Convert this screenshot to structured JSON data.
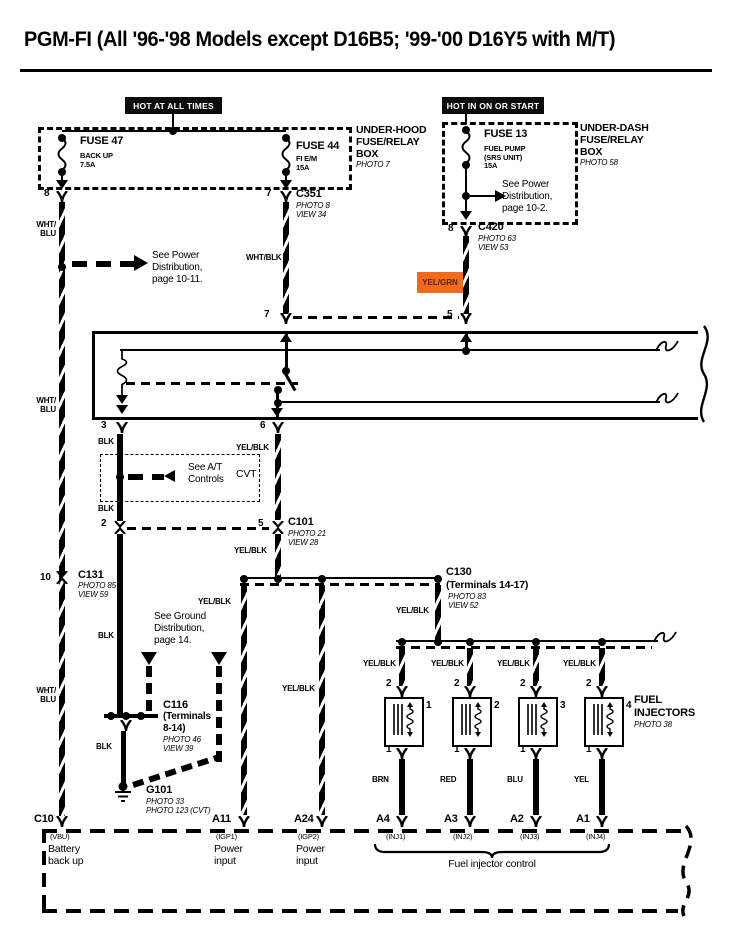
{
  "title": "PGM-FI (All '96-'98 Models except D16B5; '99-'00 D16Y5 with M/T)",
  "banners": {
    "left": "HOT AT ALL TIMES",
    "right": "HOT IN ON OR START"
  },
  "underhood": {
    "name": "UNDER-HOOD\nFUSE/RELAY\nBOX",
    "photo": "PHOTO 7",
    "fuse47": {
      "name": "FUSE 47",
      "desc": "BACK UP\n7.5A"
    },
    "fuse44": {
      "name": "FUSE 44",
      "desc": "FI E/M\n15A"
    }
  },
  "underdash": {
    "name": "UNDER-DASH\nFUSE/RELAY\nBOX",
    "photo": "PHOTO 58",
    "fuse13": {
      "name": "FUSE 13",
      "desc": "FUEL PUMP\n(SRS UNIT)\n15A"
    },
    "note": "See Power\nDistribution,\npage 10-2."
  },
  "c351": {
    "pin_l": "8",
    "pin_r": "7",
    "name": "C351",
    "photo": "PHOTO 8",
    "view": "VIEW 34"
  },
  "c420": {
    "pin_t": "8",
    "pin_b": "5",
    "name": "C420",
    "photo": "PHOTO 63",
    "view": "VIEW 53"
  },
  "relay": {
    "pin7": "7",
    "pin5": "5",
    "pin3": "3",
    "pin6": "6"
  },
  "c101": {
    "pin2": "2",
    "pin5": "5",
    "name": "C101",
    "photo": "PHOTO 21",
    "view": "VIEW 28"
  },
  "c131": {
    "pin": "10",
    "name": "C131",
    "photo": "PHOTO 85",
    "view": "VIEW 59"
  },
  "c130": {
    "name": "C130",
    "sub": "(Terminals 14-17)",
    "photo": "PHOTO 83",
    "view": "VIEW 52"
  },
  "c116": {
    "name": "C116",
    "sub": "(Terminals\n8-14)",
    "photo": "PHOTO 46",
    "view": "VIEW 39"
  },
  "g101": {
    "name": "G101",
    "photo": "PHOTO 33",
    "photo2": "PHOTO 123 (CVT)"
  },
  "notes": {
    "power11": "See Power\nDistribution,\npage 10-11.",
    "at": "See A/T\nControls",
    "cvt": "CVT",
    "ground": "See Ground\nDistribution,\npage 14."
  },
  "wires": {
    "wht_blu": "WHT/\nBLU",
    "wht_blk": "WHT/BLK",
    "yel_grn": "YEL/GRN",
    "blk": "BLK",
    "yel_blk": "YEL/BLK"
  },
  "injectors": {
    "title": "FUEL\nINJECTORS",
    "photo": "PHOTO 38",
    "items": [
      {
        "num": "1",
        "pin_top": "2",
        "pin_bot": "1",
        "color": "BRN"
      },
      {
        "num": "2",
        "pin_top": "2",
        "pin_bot": "1",
        "color": "RED"
      },
      {
        "num": "3",
        "pin_top": "2",
        "pin_bot": "1",
        "color": "BLU"
      },
      {
        "num": "4",
        "pin_top": "2",
        "pin_bot": "1",
        "color": "YEL"
      }
    ]
  },
  "ecm": {
    "bracket": "Fuel injector control",
    "terminals": [
      {
        "id": "C10",
        "code": "(VBU)",
        "desc": "Battery\nback up"
      },
      {
        "id": "A11",
        "code": "(IGP1)",
        "desc": "Power\ninput"
      },
      {
        "id": "A24",
        "code": "(IGP2)",
        "desc": "Power\ninput"
      },
      {
        "id": "A4",
        "code": "(INJ1)",
        "desc": ""
      },
      {
        "id": "A3",
        "code": "(INJ2)",
        "desc": ""
      },
      {
        "id": "A2",
        "code": "(INJ3)",
        "desc": ""
      },
      {
        "id": "A1",
        "code": "(INJ4)",
        "desc": ""
      }
    ]
  },
  "colors": {
    "highlight": "#F26B1D",
    "highlight_text": "#5a2400",
    "ink": "#000000"
  }
}
